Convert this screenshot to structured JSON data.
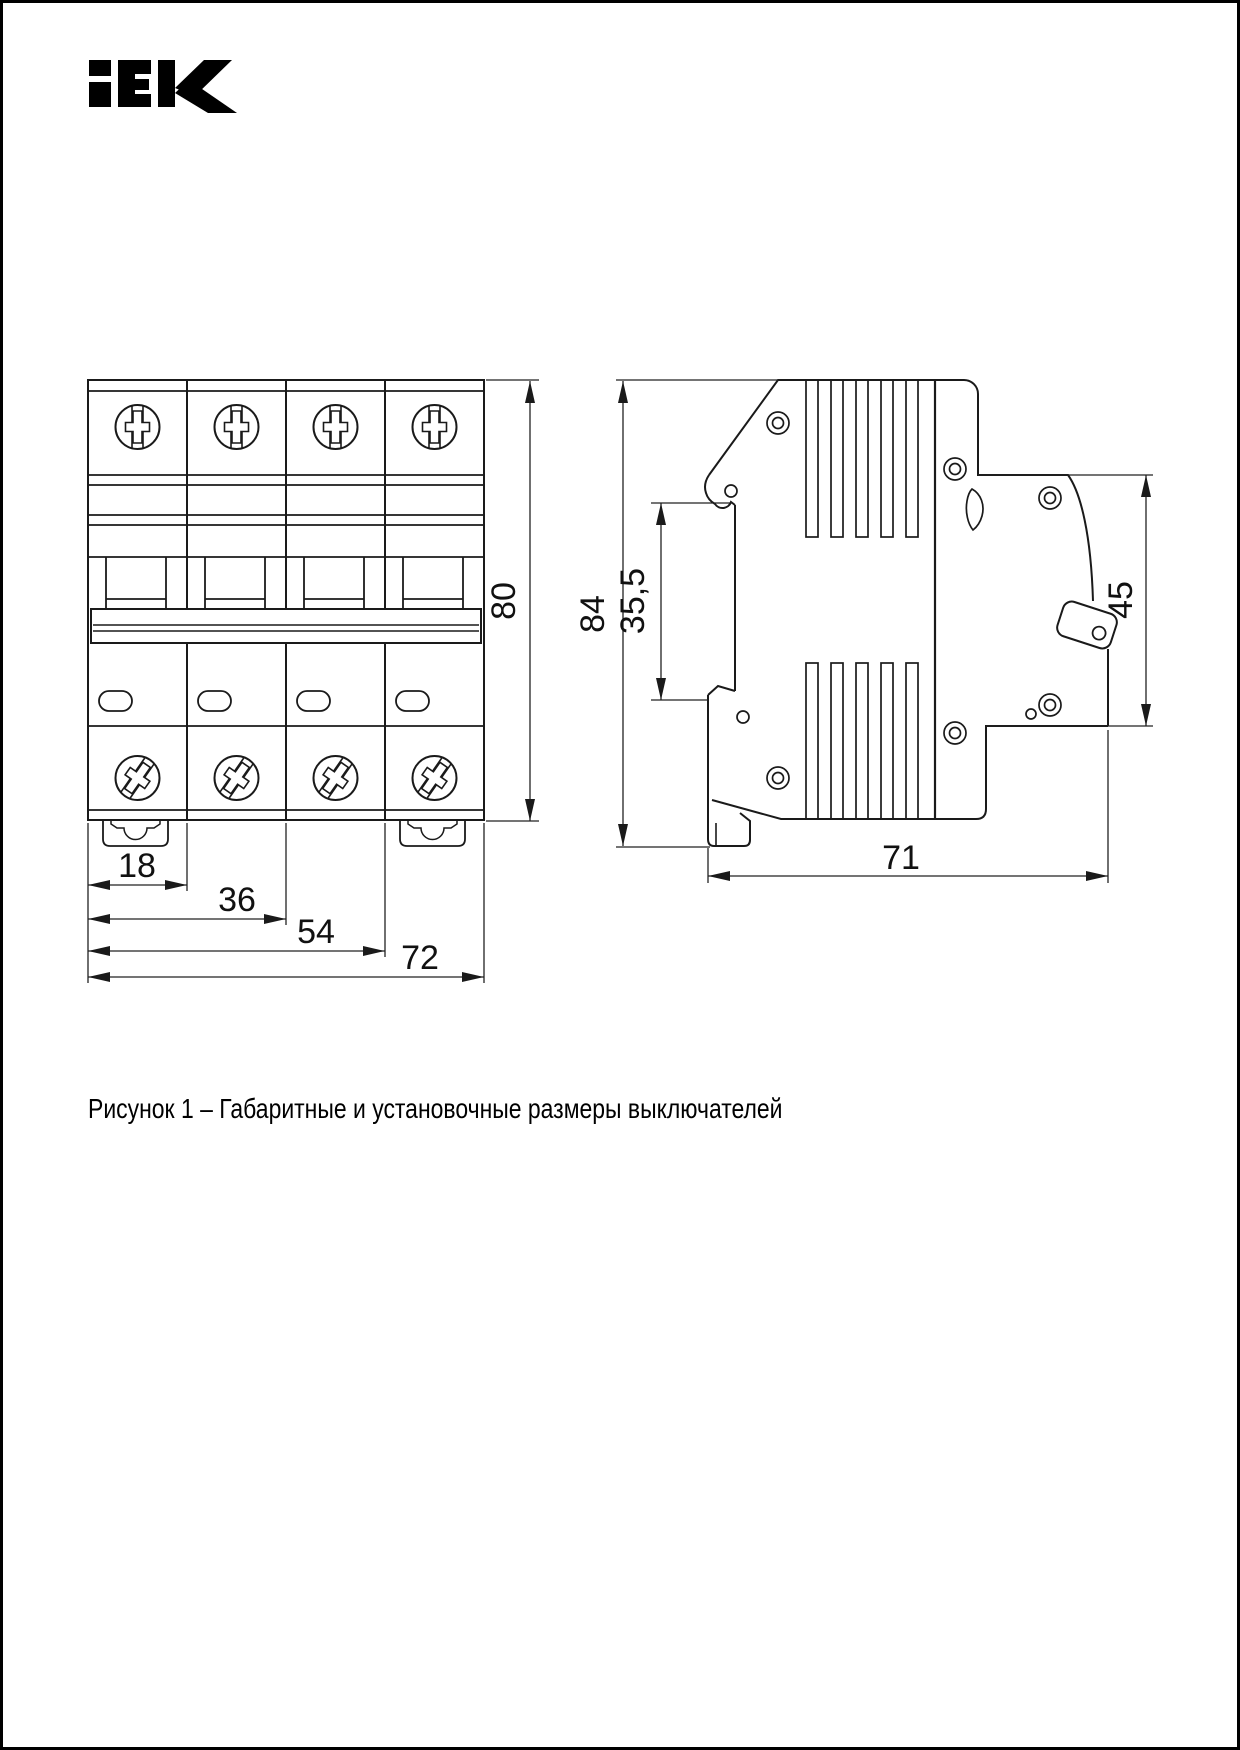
{
  "page": {
    "background": "#ffffff",
    "frame_color": "#000000"
  },
  "logo": {
    "text": "iEK",
    "color": "#000000"
  },
  "dims": {
    "d18": "18",
    "d36": "36",
    "d54": "54",
    "d72": "72",
    "d80": "80",
    "d84": "84",
    "d35_5": "35,5",
    "d45": "45",
    "d71": "71"
  },
  "caption": "Рисунок 1 – Габаритные и установочные размеры выключателей",
  "drawing": {
    "line_color": "#1a1a1a",
    "dim_line_color": "#222222",
    "text_color": "#111111"
  }
}
